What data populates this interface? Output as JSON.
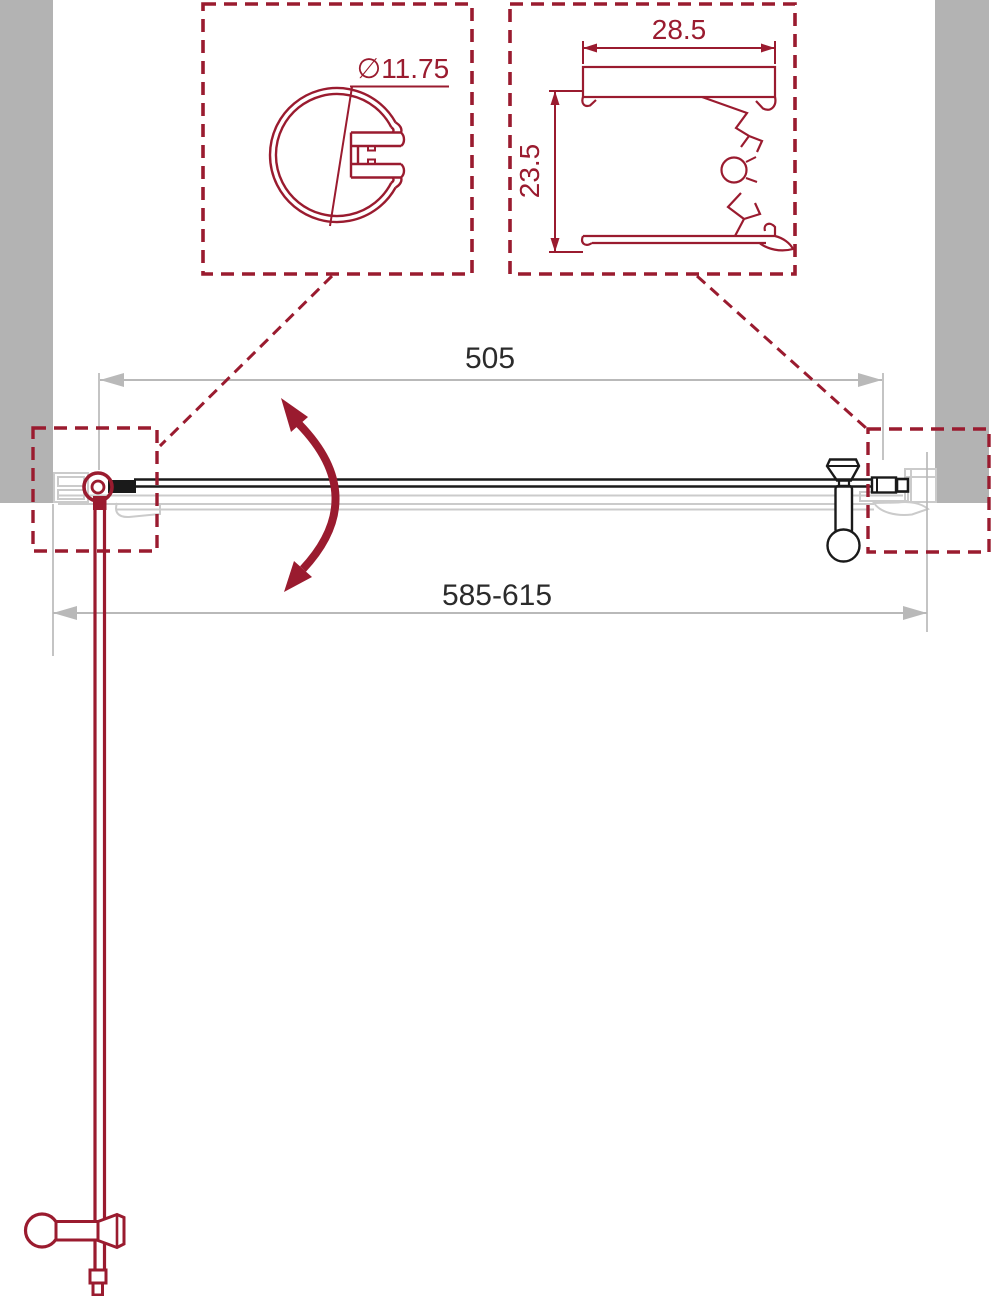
{
  "drawing": {
    "type": "technical-drawing-top-view",
    "subject": "pivot shower door installation diagram"
  },
  "colors": {
    "red": "#9A1B2F",
    "wallGray": "#B3B3B3",
    "dimGray": "#B9B9B9",
    "profileGray": "#CBCBCB",
    "ink": "#1A1A1A",
    "dimText": "#2B2B2B",
    "bg": "#FFFFFF"
  },
  "detail_views": {
    "knob_profile": {
      "diameter_label": "∅11.75"
    },
    "wall_profile": {
      "width_label": "28.5",
      "height_label": "23.5"
    }
  },
  "dimensions": {
    "glass_width": "505",
    "adjustment_range": "585-615"
  }
}
